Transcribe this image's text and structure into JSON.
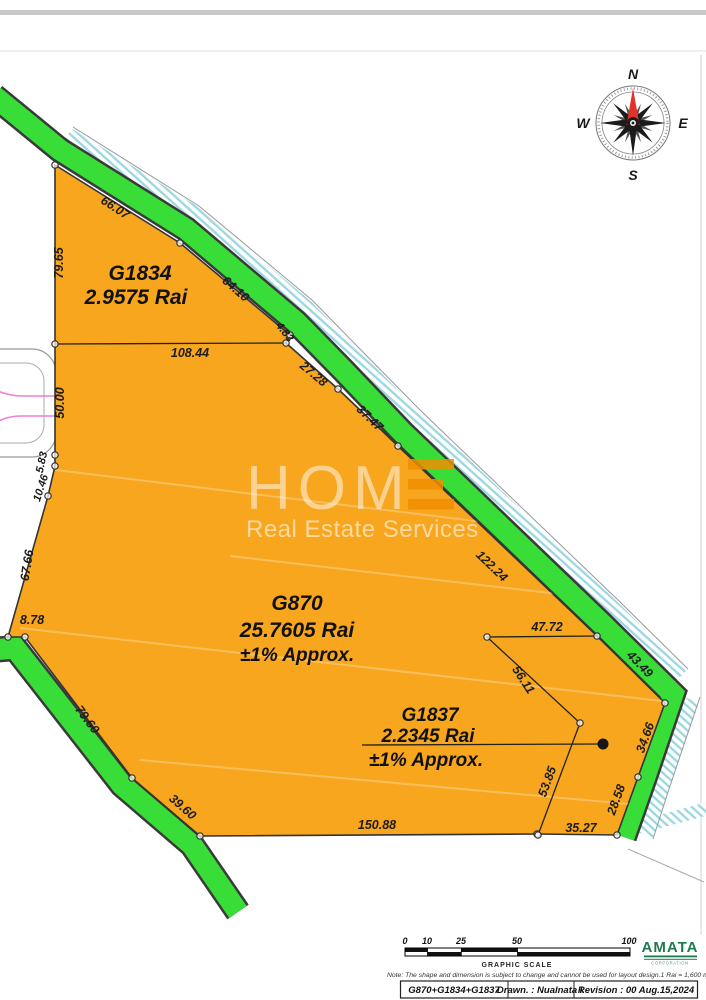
{
  "map": {
    "parcels": {
      "g1834": {
        "id": "G1834",
        "area": "2.9575 Rai"
      },
      "g870": {
        "id": "G870",
        "area": "25.7605 Rai",
        "approx": "±1% Approx."
      },
      "g1837": {
        "id": "G1837",
        "area": "2.2345 Rai",
        "approx": "±1% Approx."
      }
    },
    "edge_labels": [
      "66.07",
      "79.65",
      "64.10",
      "108.44",
      "4.83",
      "27.28",
      "37.47",
      "50.00",
      "5.83",
      "10.46",
      "67.66",
      "8.78",
      "79.60",
      "39.60",
      "150.88",
      "35.27",
      "28.58",
      "34.66",
      "43.49",
      "122.24",
      "47.72",
      "56.11",
      "53.85"
    ],
    "compass": {
      "north": "N",
      "east": "E",
      "south": "S",
      "west": "W"
    },
    "colors": {
      "parcel": "#F7A61E",
      "road_green": "#38DD38",
      "hatch_blue": "#9ED6E0",
      "pink": "#EC7FD8"
    }
  },
  "watermark": {
    "brand": "HOM",
    "tagline": "Real Estate Services"
  },
  "footer": {
    "scale_ticks": [
      "0",
      "10",
      "25",
      "50",
      "100"
    ],
    "scale_label": "GRAPHIC SCALE",
    "note": "Note: The shape and dimension is subject to change and cannot be used for layout design.1 Rai  =  1,600 m²",
    "title_block": {
      "combined": "G870+G1834+G1837",
      "drawn": "Drawn.  :  Nualnata I.",
      "revision": "Revision  :  00  Aug.15,2024"
    },
    "logo": {
      "name": "AMATA",
      "subtitle": "CORPORATION"
    }
  }
}
